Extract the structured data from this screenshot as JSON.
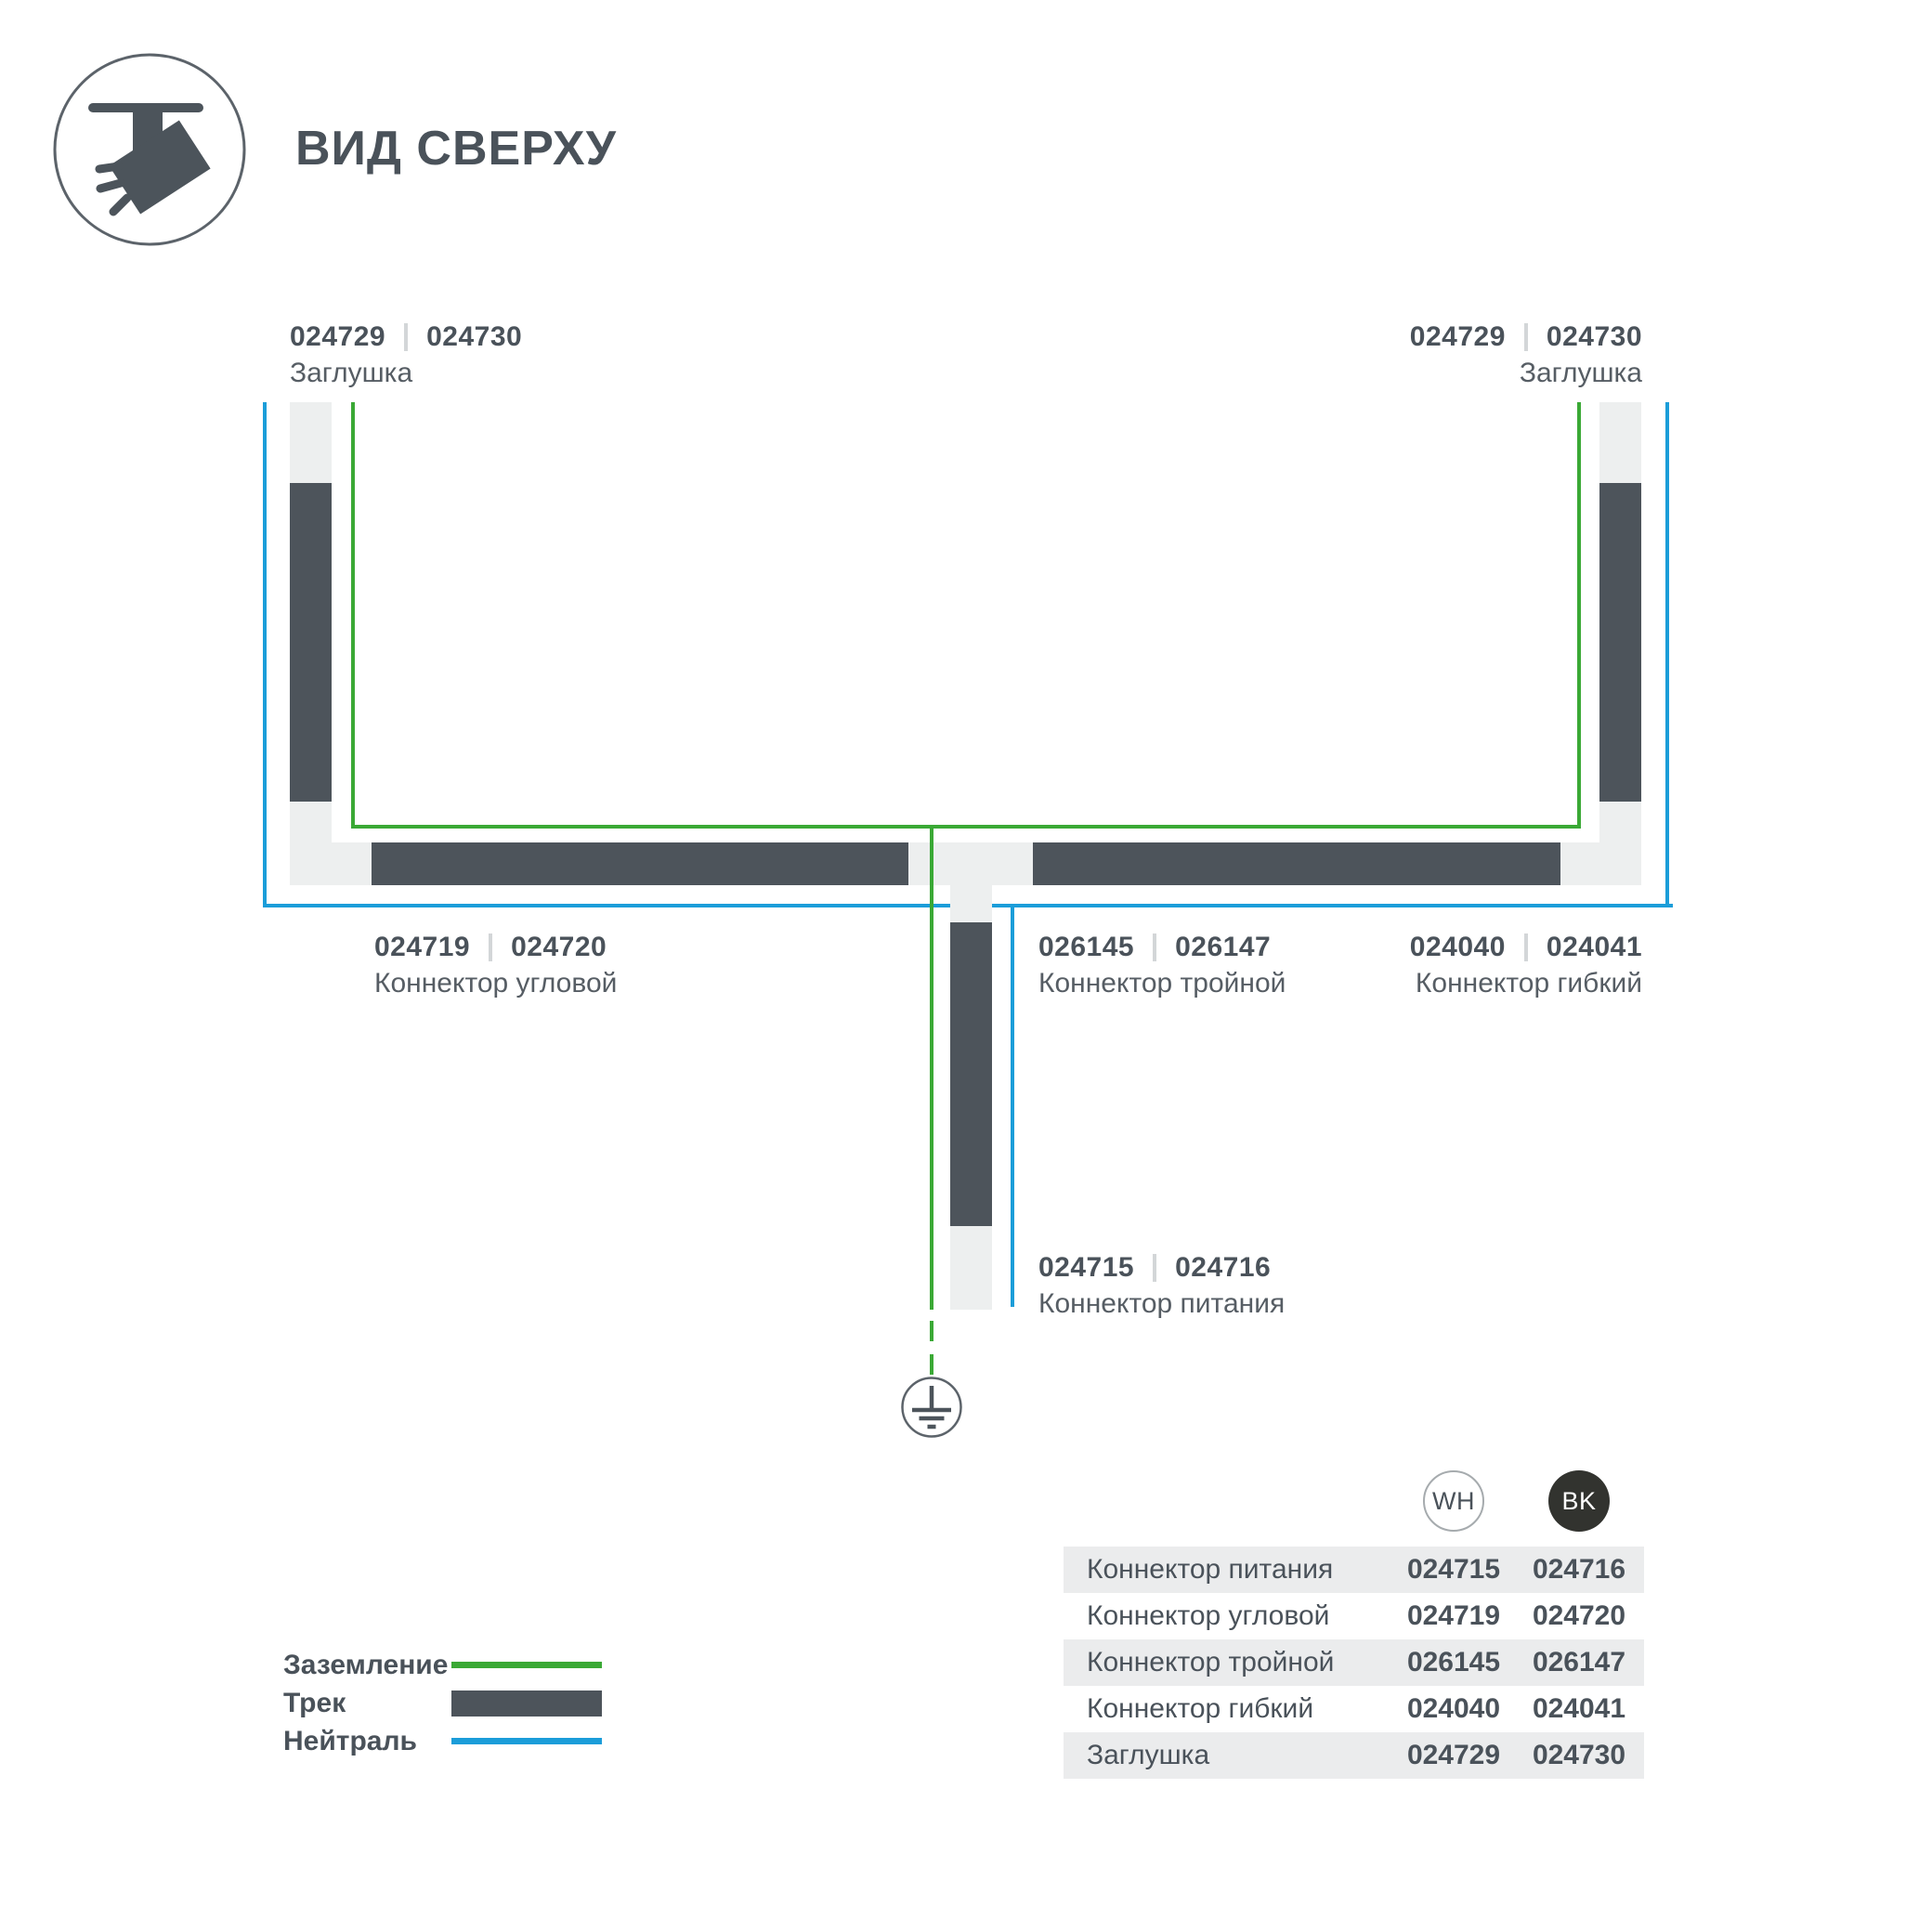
{
  "title": "ВИД СВЕРХУ",
  "icon": {
    "name": "track-spotlight-top-view"
  },
  "colors": {
    "track": "#4d545b",
    "ground": "#3aa935",
    "neutral": "#1b9dd9",
    "connector": "#edefef",
    "text_dark": "#4a525a",
    "text_caption": "#565d64",
    "table_band": "#ebeced",
    "bk_badge": "#32332f",
    "separator": "#d3d6d8"
  },
  "diagram": {
    "labels": {
      "endcap_left": {
        "code_wh": "024729",
        "code_bk": "024730",
        "caption": "Заглушка"
      },
      "endcap_right": {
        "code_wh": "024729",
        "code_bk": "024730",
        "caption": "Заглушка"
      },
      "corner": {
        "code_wh": "024719",
        "code_bk": "024720",
        "caption": "Коннектор угловой"
      },
      "triple": {
        "code_wh": "026145",
        "code_bk": "026147",
        "caption": "Коннектор тройной"
      },
      "flexible": {
        "code_wh": "024040",
        "code_bk": "024041",
        "caption": "Коннектор гибкий"
      },
      "power": {
        "code_wh": "024715",
        "code_bk": "024716",
        "caption": "Коннектор питания"
      }
    }
  },
  "legend": {
    "items": [
      {
        "label": "Заземление"
      },
      {
        "label": "Трек"
      },
      {
        "label": "Нейтраль"
      }
    ]
  },
  "table": {
    "columns": [
      {
        "id": "wh",
        "label": "WH"
      },
      {
        "id": "bk",
        "label": "BK"
      }
    ],
    "rows": [
      {
        "name": "Коннектор питания",
        "wh": "024715",
        "bk": "024716"
      },
      {
        "name": "Коннектор угловой",
        "wh": "024719",
        "bk": "024720"
      },
      {
        "name": "Коннектор тройной",
        "wh": "026145",
        "bk": "026147"
      },
      {
        "name": "Коннектор гибкий",
        "wh": "024040",
        "bk": "024041"
      },
      {
        "name": "Заглушка",
        "wh": "024729",
        "bk": "024730"
      }
    ]
  }
}
